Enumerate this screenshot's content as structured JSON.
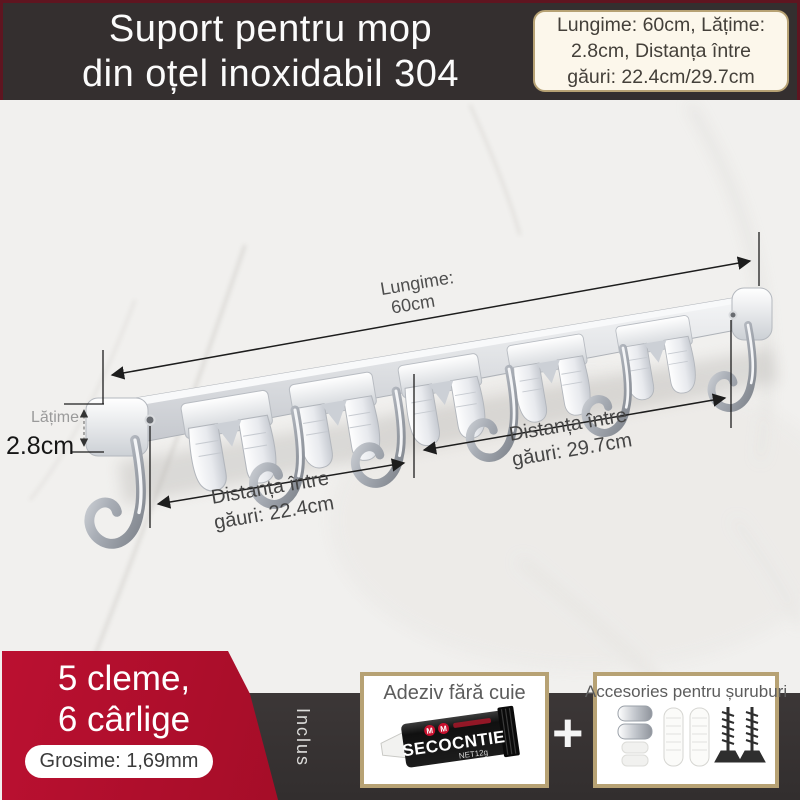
{
  "header": {
    "title_line1": "Suport pentru mop",
    "title_line2": "din oțel inoxidabil 304",
    "spec_box": {
      "line1": "Lungime: 60cm, Lățime:",
      "line2": "2.8cm, Distanța între",
      "line3": "găuri: 22.4cm/29.7cm"
    }
  },
  "diagram": {
    "length": {
      "line1": "Lungime:",
      "line2": "60cm"
    },
    "width": {
      "label": "Lățime",
      "value": "2.8cm"
    },
    "dist_left": {
      "line1": "Distanța între",
      "line2": "găuri: 22.4cm"
    },
    "dist_right": {
      "line1": "Distanța între",
      "line2": "găuri: 29.7cm"
    }
  },
  "badge": {
    "line1": "5 cleme,",
    "line2": "6 cârlige",
    "thickness": "Grosime: 1,69mm"
  },
  "included": {
    "label": "Inclus",
    "plus": "+",
    "adhesive_box": {
      "title": "Adeziv fără cuie",
      "tube_brand": "SECOCNTIE",
      "tube_net": "NET12g",
      "logo_letter": "M"
    },
    "accessories_box": {
      "title": "Accesories pentru șuruburi"
    }
  },
  "colors": {
    "accent_red": "#a50d28",
    "banner_dark": "#342f2f",
    "panel_dark": "#3a3535",
    "gold_border": "#b7a274",
    "cream_bg": "#fcf7eb"
  }
}
